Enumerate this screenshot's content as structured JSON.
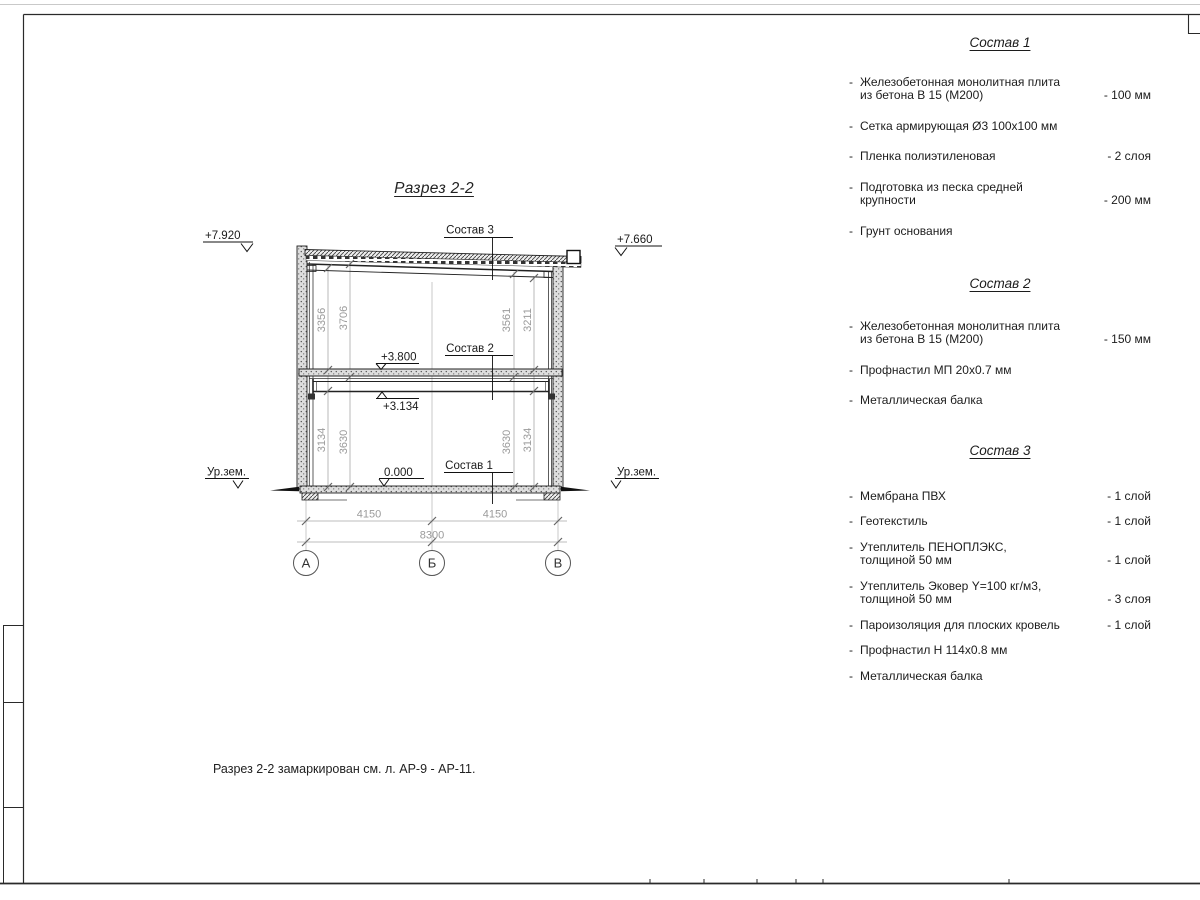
{
  "list_marker": "-",
  "drawing": {
    "title": "Разрез 2-2",
    "caption": "Разрез 2-2 замаркирован см. л. АР-9 - АР-11.",
    "elev_roof_left": "+7.920",
    "elev_roof_right": "+7.660",
    "elev_floor2": "+3.800",
    "elev_beam": "+3.134",
    "elev_zero": "0.000",
    "ground_left": "Ур.зем.",
    "ground_right": "Ур.зем.",
    "leader1": "Состав 1",
    "leader2": "Состав 2",
    "leader3": "Состав 3",
    "dims": {
      "span1": "4150",
      "span2": "4150",
      "total": "8300",
      "v_left_inner_up": "3356",
      "v_left_outer_up": "3706",
      "v_left_inner_dn": "3134",
      "v_left_outer_dn": "3630",
      "v_right_inner_up": "3561",
      "v_right_outer_up": "3211",
      "v_right_inner_dn": "3630",
      "v_right_outer_dn": "3134"
    },
    "axes": {
      "a": "А",
      "b": "Б",
      "v": "В"
    }
  },
  "specs": [
    {
      "title": "Состав 1",
      "items": [
        {
          "text": "Железобетонная  монолитная плита\nиз бетона В 15 (М200)",
          "qty": "- 100 мм"
        },
        {
          "text": "Сетка армирующая Ø3 100x100 мм",
          "qty": ""
        },
        {
          "text": "Пленка полиэтиленовая",
          "qty": "-  2 слоя"
        },
        {
          "text": "Подготовка из песка средней\nкрупности",
          "qty": "- 200 мм"
        },
        {
          "text": "Грунт основания",
          "qty": ""
        }
      ]
    },
    {
      "title": "Состав 2",
      "items": [
        {
          "text": "Железобетонная  монолитная плита\nиз бетона В 15 (М200)",
          "qty": "- 150 мм"
        },
        {
          "text": "Профнастил МП 20x0.7 мм",
          "qty": ""
        },
        {
          "text": "Металлическая балка",
          "qty": ""
        }
      ]
    },
    {
      "title": "Состав 3",
      "items": [
        {
          "text": "Мембрана ПВХ",
          "qty": "- 1 слой"
        },
        {
          "text": "Геотекстиль",
          "qty": "- 1 слой"
        },
        {
          "text": "Утеплитель ПЕНОПЛЭКС,\nтолщиной 50 мм",
          "qty": "- 1 слой"
        },
        {
          "text": "Утеплитель Эковер Y=100 кг/м3,\nтолщиной 50 мм",
          "qty": "- 3 слоя"
        },
        {
          "text": "Пароизоляция для плоских кровель",
          "qty": "- 1 слой"
        },
        {
          "text": "Профнастил Н 114x0.8 мм",
          "qty": ""
        },
        {
          "text": "Металлическая балка",
          "qty": ""
        }
      ]
    }
  ],
  "colors": {
    "line": "#222222",
    "dim_gray": "#9a9a9a"
  }
}
